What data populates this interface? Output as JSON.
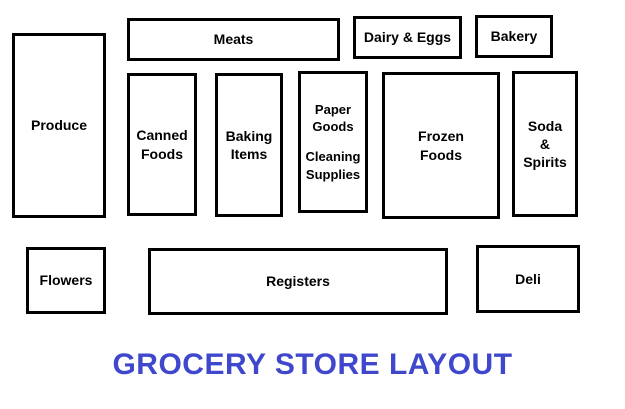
{
  "title": "GROCERY STORE LAYOUT",
  "colors": {
    "title_text": "#3F48CC",
    "box_border": "#000000",
    "background": "#FFFFFF"
  },
  "rooms": {
    "produce": {
      "label": "Produce"
    },
    "meats": {
      "label": "Meats"
    },
    "dairy_eggs": {
      "label": "Dairy & Eggs"
    },
    "bakery": {
      "label": "Bakery"
    },
    "canned_foods": {
      "label": "Canned\nFoods"
    },
    "baking_items": {
      "label": "Baking\nItems"
    },
    "paper_cleaning": {
      "label_top": "Paper\nGoods",
      "label_bottom": "Cleaning\nSupplies"
    },
    "frozen_foods": {
      "label": "Frozen\nFoods"
    },
    "soda_spirits": {
      "label": "Soda\n&\nSpirits"
    },
    "flowers": {
      "label": "Flowers"
    },
    "registers": {
      "label": "Registers"
    },
    "deli": {
      "label": "Deli"
    }
  }
}
